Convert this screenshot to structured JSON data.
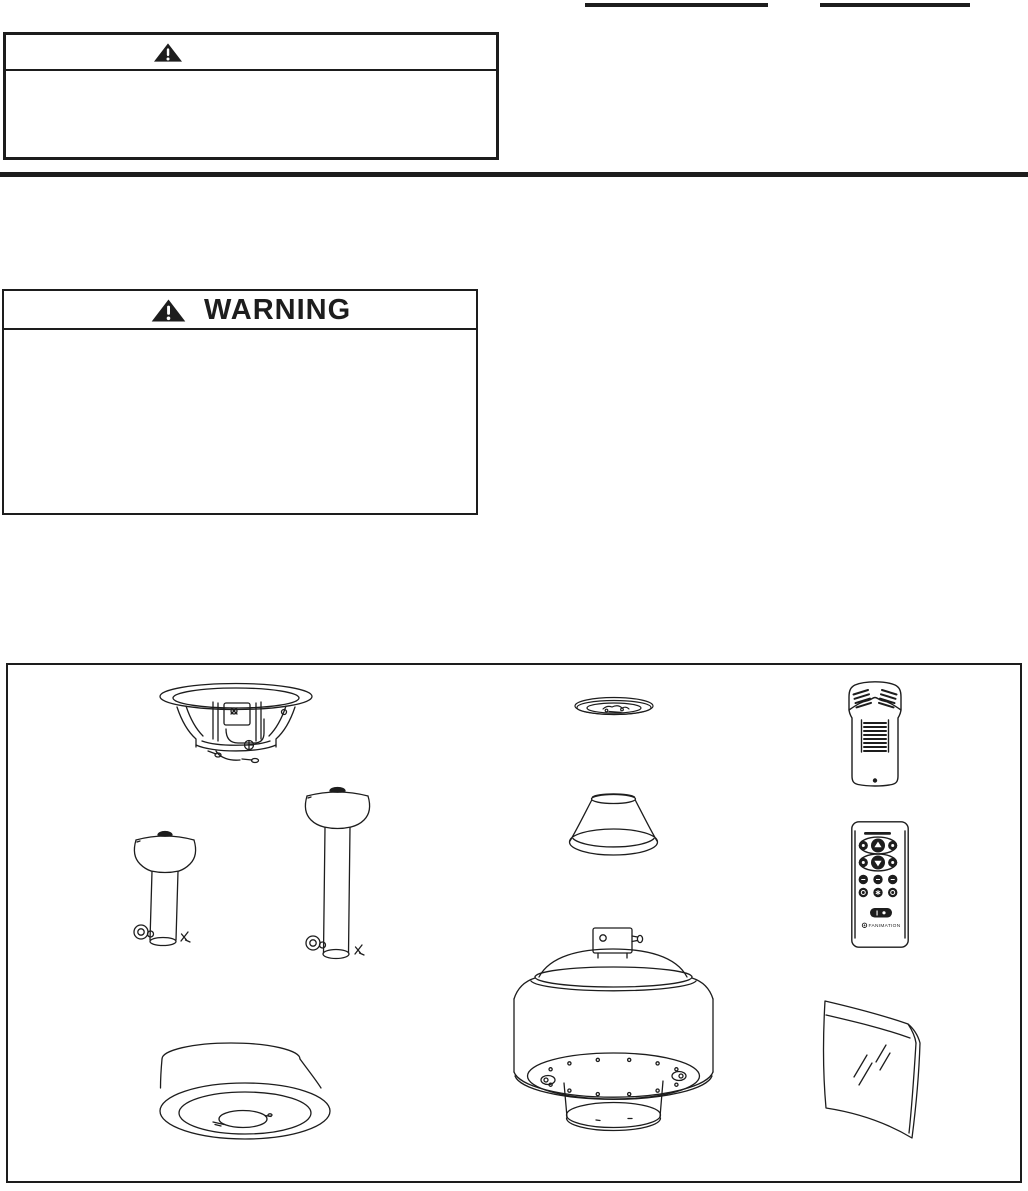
{
  "document": {
    "ink_color": "#1d1d1d",
    "paper_color": "#ffffff"
  },
  "header": {
    "fill_in_line_1": "",
    "fill_in_line_2": ""
  },
  "caution_box": {
    "icon": "warning-triangle-icon",
    "heading": "",
    "body": ""
  },
  "warning_box": {
    "icon": "warning-triangle-icon",
    "heading": "WARNING",
    "body": ""
  },
  "parts_diagram": {
    "drawings": [
      {
        "id": "ceiling-mount-bracket"
      },
      {
        "id": "short-downrod-with-ball"
      },
      {
        "id": "long-downrod-with-ball"
      },
      {
        "id": "ceiling-canopy"
      },
      {
        "id": "ceiling-trim-ring"
      },
      {
        "id": "coupling-cover-cone"
      },
      {
        "id": "fan-motor-assembly"
      },
      {
        "id": "remote-receiver"
      },
      {
        "id": "remote-control"
      },
      {
        "id": "glass-side-panel"
      }
    ],
    "remote": {
      "brand_label": "FANIMATION",
      "power_button_label": "I"
    }
  }
}
